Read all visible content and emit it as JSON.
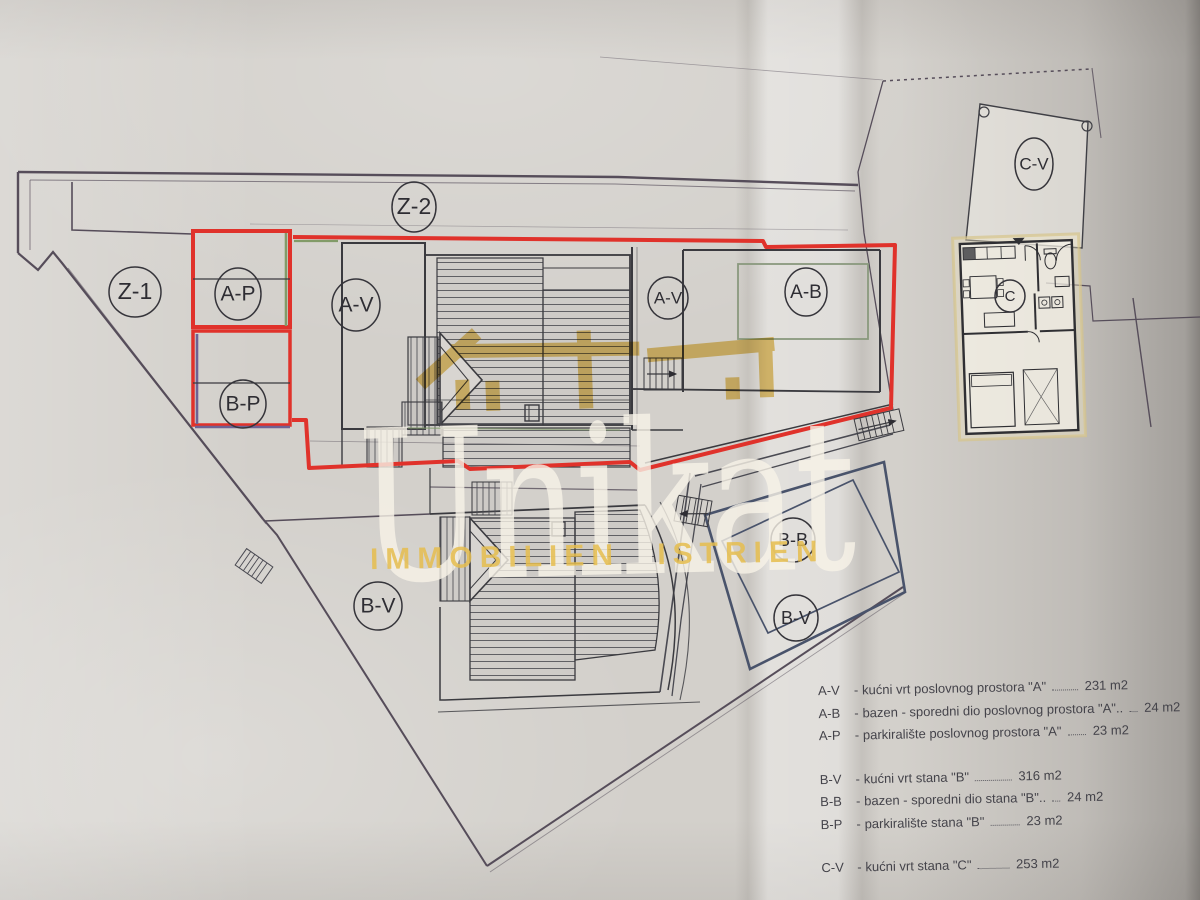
{
  "plan": {
    "labels": [
      {
        "id": "zone-z1",
        "text": "Z-1"
      },
      {
        "id": "zone-z2",
        "text": "Z-2"
      },
      {
        "id": "parking-a",
        "text": "A-P"
      },
      {
        "id": "parking-b",
        "text": "B-P"
      },
      {
        "id": "garden-a-main",
        "text": "A-V"
      },
      {
        "id": "garden-a-2",
        "text": "A-V"
      },
      {
        "id": "pool-a",
        "text": "A-B"
      },
      {
        "id": "garden-c",
        "text": "C-V"
      },
      {
        "id": "apartment-c",
        "text": "C"
      },
      {
        "id": "pool-b",
        "text": "B-B"
      },
      {
        "id": "garden-b-2",
        "text": "B-V"
      },
      {
        "id": "garden-b-main",
        "text": "B-V"
      }
    ],
    "colors": {
      "parcel_red": "#e0322b",
      "accent_green": "#829b68",
      "accent_purple": "#6e6294",
      "parcel_blue": "#49536b",
      "line_dark": "#3b3a40"
    }
  },
  "watermark": {
    "title": "Unikat",
    "subtitle": "IMMOBILIEN ISTRIEN",
    "icon": "house-roof-icon",
    "yellow": "#e6c25d",
    "cream": "#f3efe6"
  },
  "legend": {
    "separator": "-",
    "groups": [
      {
        "items": [
          {
            "code": "A-V",
            "desc": "kućni vrt  poslovnog prostora \"A\"",
            "area": "231 m2"
          },
          {
            "code": "A-B",
            "desc": "bazen - sporedni dio poslovnog prostora \"A\"..",
            "area": "24 m2"
          },
          {
            "code": "A-P",
            "desc": "parkiralište  poslovnog prostora \"A\"",
            "area": "23 m2"
          }
        ]
      },
      {
        "items": [
          {
            "code": "B-V",
            "desc": "kućni vrt  stana \"B\"",
            "area": "316 m2"
          },
          {
            "code": "B-B",
            "desc": "bazen - sporedni dio stana \"B\"..",
            "area": "24 m2"
          },
          {
            "code": "B-P",
            "desc": "parkiralište  stana \"B\"",
            "area": "23 m2"
          }
        ]
      },
      {
        "items": [
          {
            "code": "C-V",
            "desc": "kućni vrt  stana \"C\"",
            "area": "253 m2"
          }
        ]
      }
    ]
  }
}
